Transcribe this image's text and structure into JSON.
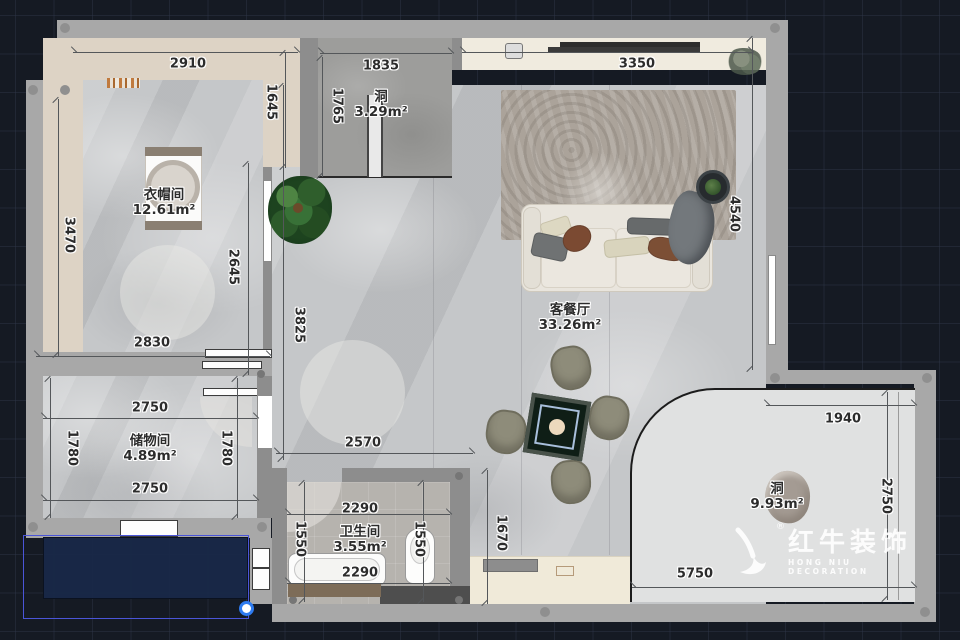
{
  "rooms": [
    {
      "id": "cloakroom",
      "label": "衣帽间",
      "area": "12.61m²",
      "x": 164,
      "y": 203
    },
    {
      "id": "hole-top",
      "label": "洞",
      "area": "3.29m²",
      "x": 381,
      "y": 105
    },
    {
      "id": "living-dining",
      "label": "客餐厅",
      "area": "33.26m²",
      "x": 570,
      "y": 318
    },
    {
      "id": "storage",
      "label": "储物间",
      "area": "4.89m²",
      "x": 150,
      "y": 449
    },
    {
      "id": "bathroom",
      "label": "卫生间",
      "area": "3.55m²",
      "x": 360,
      "y": 540
    },
    {
      "id": "hole-bottom",
      "label": "洞",
      "area": "9.93m²",
      "x": 777,
      "y": 497
    }
  ],
  "dimensions": [
    {
      "value": "2910",
      "x": 188,
      "y": 64,
      "vertical": false
    },
    {
      "value": "1835",
      "x": 381,
      "y": 66,
      "vertical": false
    },
    {
      "value": "3350",
      "x": 637,
      "y": 64,
      "vertical": false
    },
    {
      "value": "1645",
      "x": 271,
      "y": 102,
      "vertical": true
    },
    {
      "value": "1765",
      "x": 337,
      "y": 106,
      "vertical": true
    },
    {
      "value": "3470",
      "x": 69,
      "y": 235,
      "vertical": true
    },
    {
      "value": "2645",
      "x": 233,
      "y": 267,
      "vertical": true
    },
    {
      "value": "3825",
      "x": 299,
      "y": 325,
      "vertical": true
    },
    {
      "value": "4540",
      "x": 734,
      "y": 214,
      "vertical": true
    },
    {
      "value": "2830",
      "x": 152,
      "y": 343,
      "vertical": false
    },
    {
      "value": "2750",
      "x": 150,
      "y": 408,
      "vertical": false
    },
    {
      "value": "1780",
      "x": 72,
      "y": 448,
      "vertical": true
    },
    {
      "value": "1780",
      "x": 226,
      "y": 448,
      "vertical": true
    },
    {
      "value": "2750",
      "x": 150,
      "y": 489,
      "vertical": false
    },
    {
      "value": "2570",
      "x": 363,
      "y": 443,
      "vertical": false
    },
    {
      "value": "2290",
      "x": 360,
      "y": 509,
      "vertical": false
    },
    {
      "value": "1550",
      "x": 300,
      "y": 539,
      "vertical": true
    },
    {
      "value": "1550",
      "x": 419,
      "y": 539,
      "vertical": true
    },
    {
      "value": "2290",
      "x": 360,
      "y": 573,
      "vertical": false
    },
    {
      "value": "1670",
      "x": 501,
      "y": 533,
      "vertical": true
    },
    {
      "value": "1940",
      "x": 843,
      "y": 419,
      "vertical": false
    },
    {
      "value": "2750",
      "x": 886,
      "y": 496,
      "vertical": true
    },
    {
      "value": "5750",
      "x": 695,
      "y": 574,
      "vertical": false
    }
  ],
  "logo": {
    "brand": "红牛装饰",
    "subtitle": "HONG NIU DECORATION",
    "registered": "®"
  },
  "colors": {
    "canvas_background": "#151a23",
    "wall_gray": "#a8a8a8",
    "beige_band": "#ddd3c5",
    "selection_blue": "#2e7bf0",
    "selection_outline": "#4a55d8",
    "selection_fill": "#182848"
  }
}
